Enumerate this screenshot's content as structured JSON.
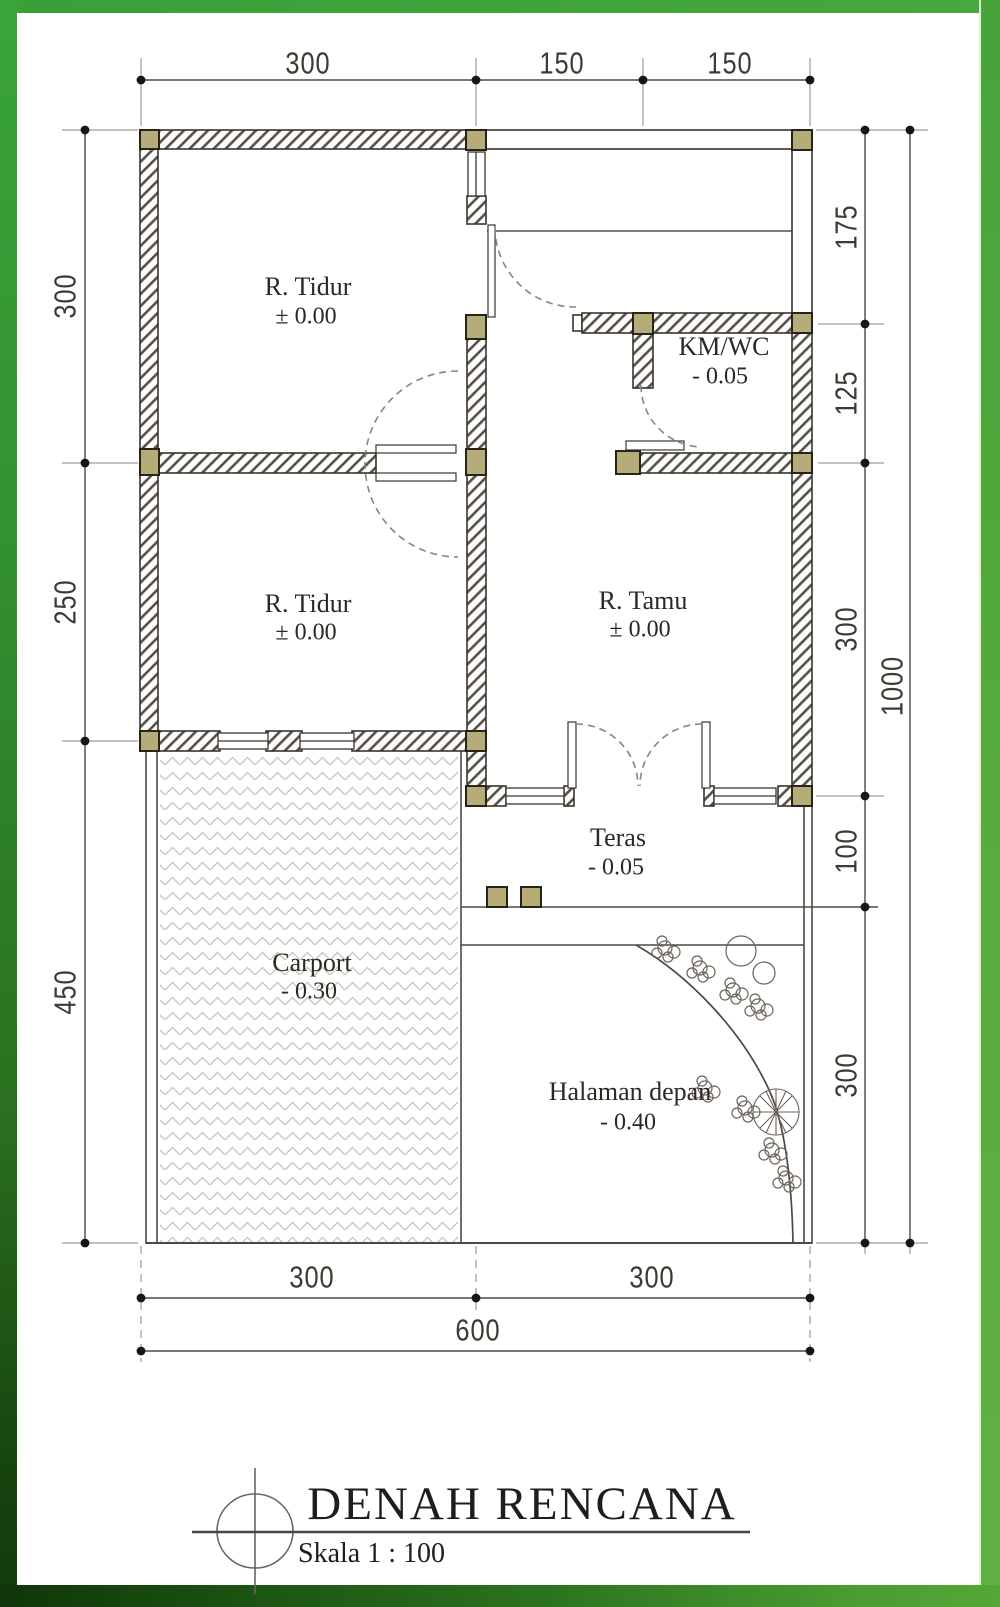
{
  "title_block": {
    "title": "DENAH RENCANA",
    "scale": "Skala 1 : 100"
  },
  "rooms": [
    {
      "name": "R. Tidur",
      "level": "± 0.00"
    },
    {
      "name": "KM/WC",
      "level": "- 0.05"
    },
    {
      "name": "R. Tidur",
      "level": "± 0.00"
    },
    {
      "name": "R. Tamu",
      "level": "± 0.00"
    },
    {
      "name": "Teras",
      "level": "- 0.05"
    },
    {
      "name": "Carport",
      "level": "- 0.30"
    },
    {
      "name": "Halaman depan",
      "level": "- 0.40"
    }
  ],
  "dimensions": {
    "top": [
      "300",
      "150",
      "150"
    ],
    "left": [
      "300",
      "250",
      "450"
    ],
    "right": [
      "175",
      "125",
      "300",
      "100",
      "300"
    ],
    "right_total": "1000",
    "bottom": [
      "300",
      "300"
    ],
    "bottom_total": "600"
  },
  "colors": {
    "frame_green": "#3fa43c",
    "frame_dark": "#133c0c",
    "column_fill": "#b5ac77",
    "wall_line": "#3a352c",
    "hatch_line": "#57514a",
    "paving_line": "#ccc6bb"
  }
}
